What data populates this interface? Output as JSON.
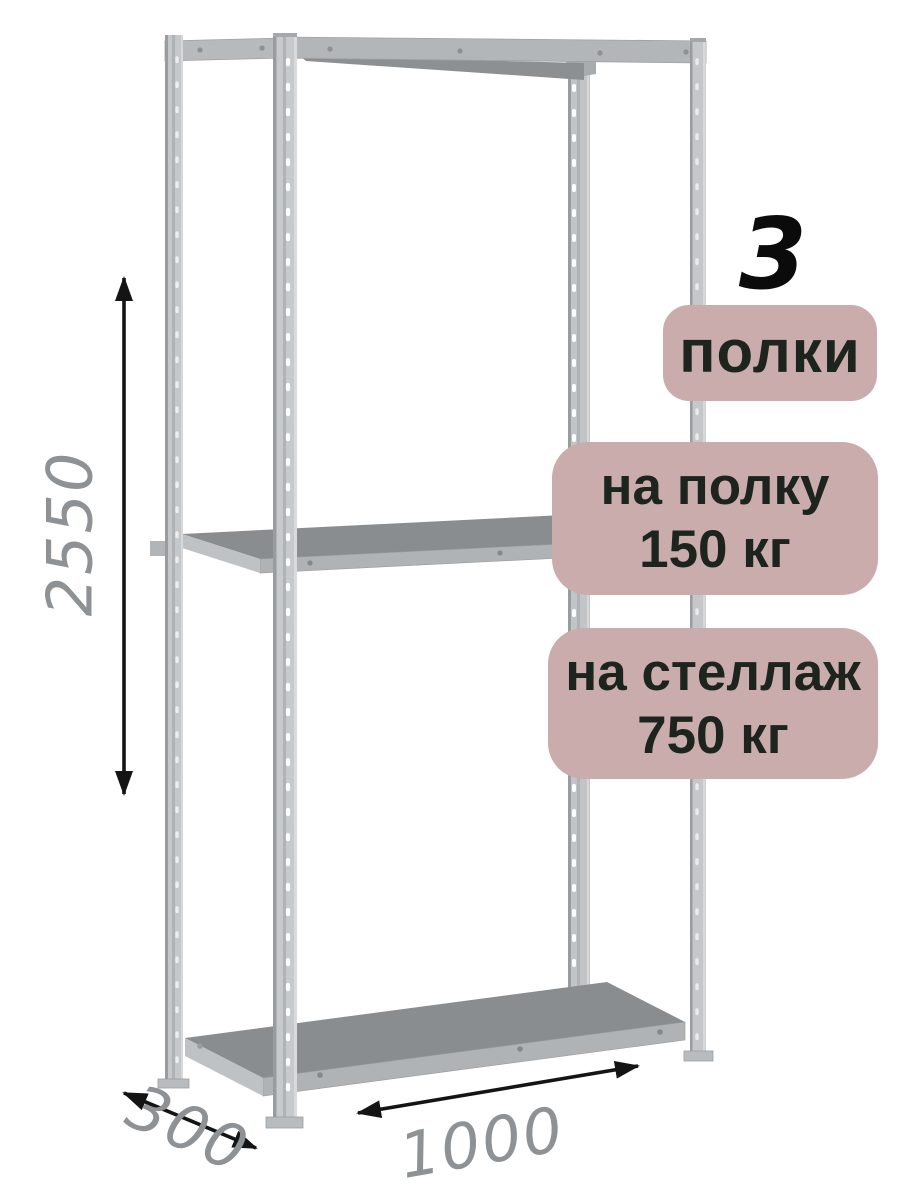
{
  "page": {
    "background": "#ffffff",
    "description": "metal shelving rack product diagram"
  },
  "colors": {
    "page_bg": "#ffffff",
    "badge_bg": "#caacac",
    "badge_text": "#1c241d",
    "dim_text": "#8f9294",
    "arrow": "#141414",
    "metal_light": "#c5c8ca",
    "metal_mid": "#b1b4b6",
    "metal_dark": "#8a8d8f"
  },
  "highlights": {
    "shelf_count": "3",
    "shelves_label": "полки",
    "per_shelf_line1": "на полку",
    "per_shelf_line2": "150 кг",
    "per_rack_line1": "на стеллаж",
    "per_rack_line2": "750 кг"
  },
  "dimensions": {
    "height": "2550",
    "depth": "300",
    "width": "1000"
  }
}
